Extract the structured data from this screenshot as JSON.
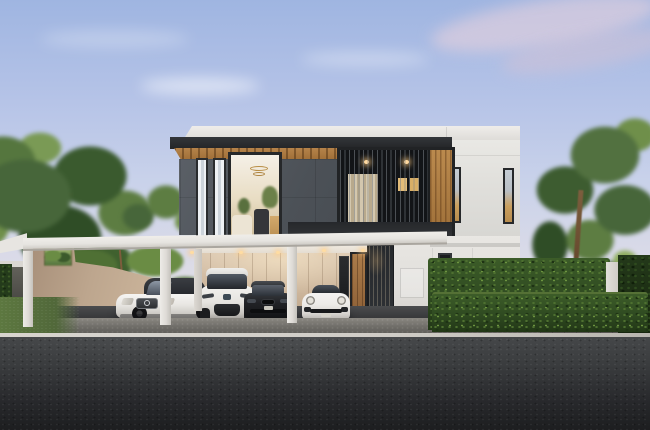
{
  "scene": {
    "title": "Architectural rendering of a modern two-story house at dusk with a four-bay carport, parked cars, trimmed hedges, trees and an asphalt road in the foreground",
    "objects": {
      "sky": {
        "label": "Dusk sky with soft pink clouds"
      },
      "trees_left": {
        "label": "Leafy trees on the left"
      },
      "tree_right": {
        "label": "Tree on the right"
      },
      "house": {
        "label": "Modern two-story house with dark stone upper facade, wood soffit and white volumes"
      },
      "upper_window": {
        "label": "Lit upper-floor window with chandelier and plants"
      },
      "slat_screen": {
        "label": "Dark vertical slat screen with warm lit windows"
      },
      "carport": {
        "label": "White flat-roof carport"
      },
      "garage_wall": {
        "label": "Beige paneled garage back wall"
      },
      "entrance": {
        "label": "Wooden front door with dark slatted gate"
      },
      "car_sedan_white": {
        "label": "White luxury sedan"
      },
      "car_suv_white": {
        "label": "White compact SUV"
      },
      "car_sedan_black": {
        "label": "Black sedan"
      },
      "car_sports_white": {
        "label": "White sports car"
      },
      "hedge": {
        "label": "Trimmed two-tier green hedge"
      },
      "lawn": {
        "label": "Green lawn strip"
      },
      "road": {
        "label": "Dark asphalt road with light curb line"
      }
    },
    "palette": {
      "sky_top": "#9fb5e1",
      "sky_horizon": "#eae4e2",
      "cloud_pink": "#e2d0dd",
      "facade_dark": "#4c5157",
      "soffit_wood": "#a5763f",
      "white_wall": "#e6e4e0",
      "beige_wall": "#c9b49c",
      "window_glow": "#e3bc78",
      "hedge_green": "#2f4a21",
      "tree_green": "#47663a",
      "grass_green": "#5d7840",
      "asphalt": "#26272a",
      "curb_line": "#cfccc6",
      "carport_white": "#eceae6"
    }
  }
}
